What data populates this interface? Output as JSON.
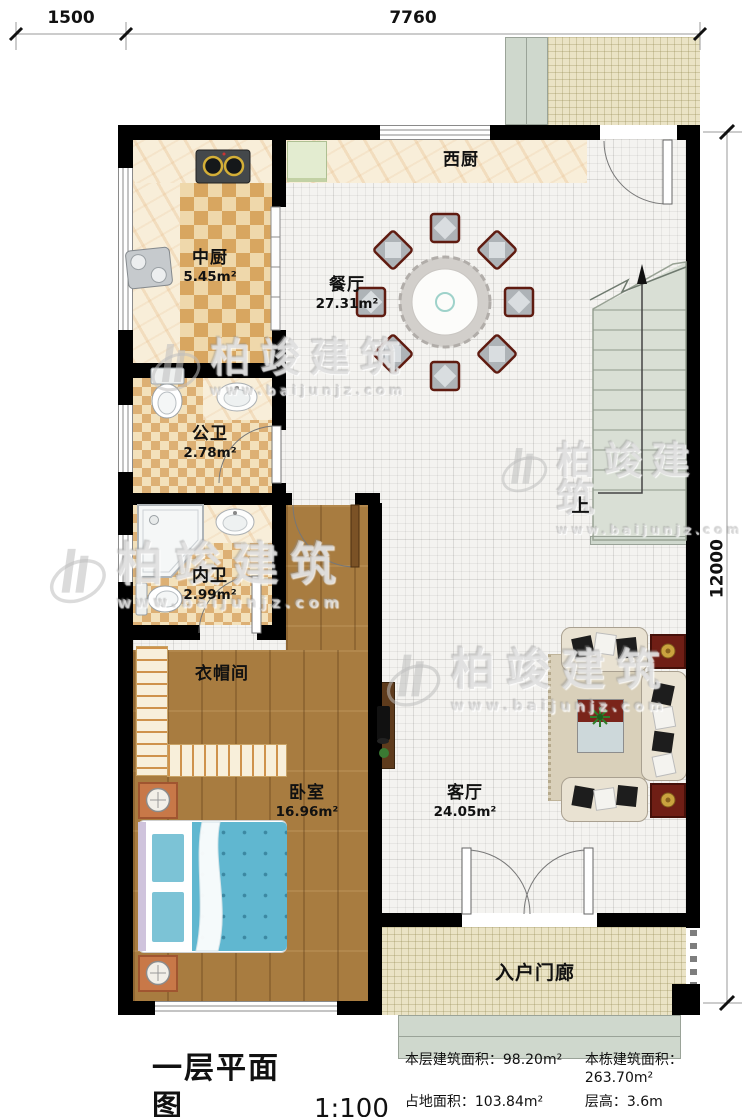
{
  "dimensions": {
    "top": [
      {
        "label": "1500"
      },
      {
        "label": "7760"
      }
    ],
    "right": {
      "label": "12000"
    }
  },
  "rooms": {
    "west_kitchen": {
      "name": "西厨"
    },
    "chinese_kitchen": {
      "name": "中厨",
      "area": "5.45m²"
    },
    "dining": {
      "name": "餐厅",
      "area": "27.31m²"
    },
    "public_bath": {
      "name": "公卫",
      "area": "2.78m²"
    },
    "ensuite_bath": {
      "name": "内卫",
      "area": "2.99m²"
    },
    "cloakroom": {
      "name": "衣帽间"
    },
    "bedroom": {
      "name": "卧室",
      "area": "16.96m²"
    },
    "living": {
      "name": "客厅",
      "area": "24.05m²"
    },
    "entry_porch": {
      "name": "入户门廊"
    },
    "stair": {
      "up_label": "上"
    }
  },
  "title_block": {
    "title": "一层平面图",
    "scale": "1:100",
    "floor_area": "本层建筑面积：98.20m²",
    "site_area": "占地面积：103.84m²",
    "total_area": "本栋建筑面积：263.70m²",
    "floor_height": "层高：3.6m"
  },
  "watermark": {
    "brand": "柏竣建筑",
    "url": "www.baijunjz.com"
  },
  "colors": {
    "wall": "#000000",
    "wood_floor": "#a87c40",
    "kitchen_tile_dark": "#d8a660",
    "kitchen_tile_light": "#efd8ab",
    "bed_blue": "#60b7d0",
    "stair_green": "#d9dfd5",
    "porch_tan": "#eae3c5",
    "accent_red_table": "#6f1e15"
  }
}
